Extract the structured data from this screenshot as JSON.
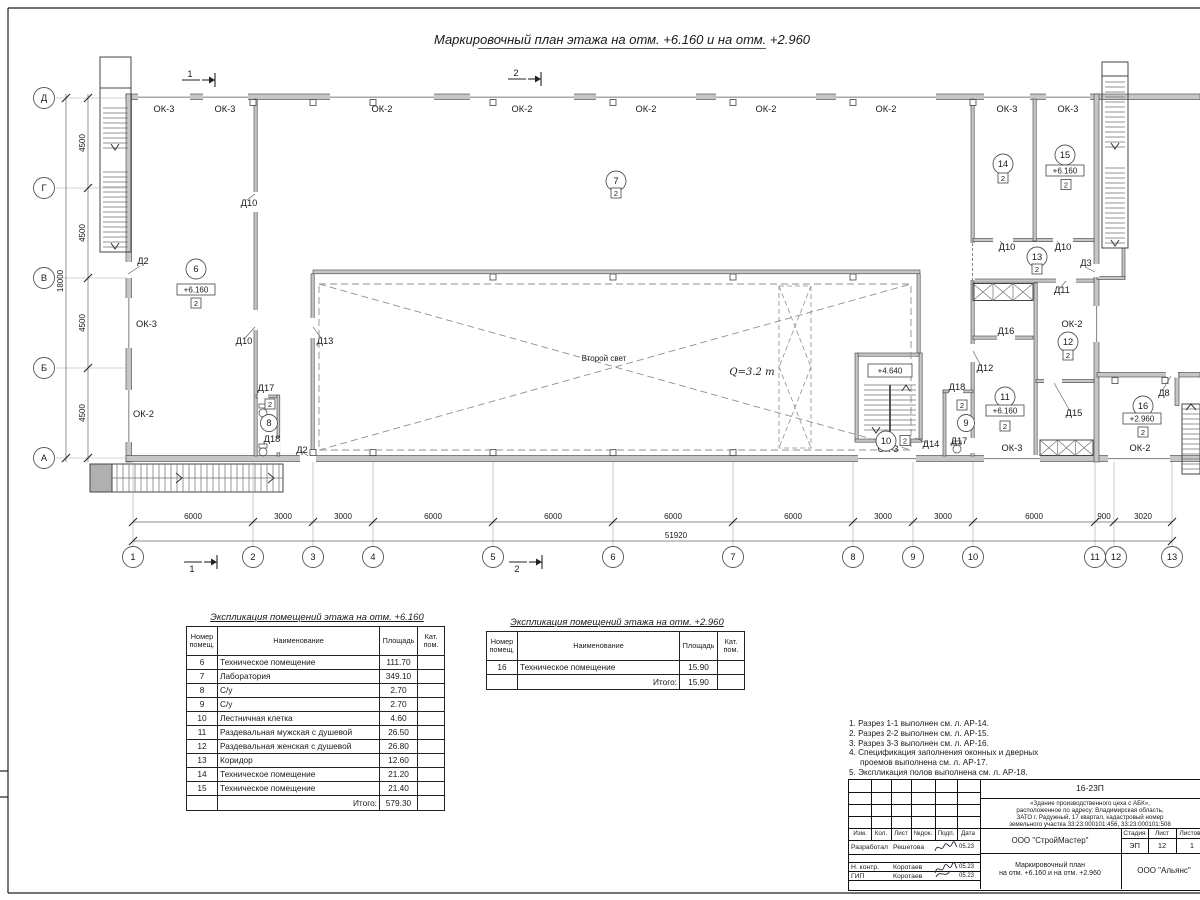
{
  "sheet_title": "Маркировочный план этажа на отм. +6.160 и на отм. +2.960",
  "plan": {
    "windows": {
      "top": [
        "ОК-3",
        "ОК-3",
        "ОК-2",
        "ОК-2",
        "ОК-2",
        "ОК-2",
        "ОК-2",
        "ОК-3",
        "ОК-3"
      ],
      "left": [
        "ОК-3",
        "ОК-2"
      ],
      "right": [
        "ОК-2"
      ],
      "bottom": [
        "ОК-3",
        "ОК-3",
        "ОК-2"
      ]
    },
    "doors": [
      "Д2",
      "Д10",
      "Д10",
      "Д13",
      "Д17",
      "Д18",
      "Д2",
      "Д14",
      "Д18",
      "Д17",
      "Д12",
      "Д16",
      "Д11",
      "Д3",
      "Д10",
      "Д10",
      "Д15",
      "Д8"
    ],
    "rooms": [
      {
        "num": "6",
        "elev": "+6.160",
        "cat": "2"
      },
      {
        "num": "7",
        "cat": "2"
      },
      {
        "num": "8",
        "cat": "2"
      },
      {
        "num": "9",
        "cat": "2"
      },
      {
        "num": "10",
        "cat": "2"
      },
      {
        "num": "11",
        "elev": "+6.160",
        "cat": "2"
      },
      {
        "num": "12",
        "cat": "2"
      },
      {
        "num": "13",
        "cat": "2"
      },
      {
        "num": "14",
        "cat": "2"
      },
      {
        "num": "15",
        "elev": "+6.160",
        "cat": "2"
      },
      {
        "num": "16",
        "elev": "+2.960",
        "cat": "2"
      }
    ],
    "stair_elev": "+4.640",
    "second_light": "Второй свет",
    "crane": "Q=3.2 т",
    "sections": {
      "s1": "1",
      "s2": "2"
    },
    "axes_v": [
      "1",
      "2",
      "3",
      "4",
      "5",
      "6",
      "7",
      "8",
      "9",
      "10",
      "11",
      "12",
      "13"
    ],
    "axes_h": [
      "Д",
      "Г",
      "В",
      "Б",
      "А"
    ],
    "dims_bottom": [
      "6000",
      "3000",
      "3000",
      "6000",
      "6000",
      "6000",
      "6000",
      "3000",
      "3000",
      "6000",
      "900",
      "3020"
    ],
    "dim_bottom_total": "51920",
    "dims_left": [
      "4500",
      "4500",
      "4500",
      "4500"
    ],
    "dim_left_total": "18000"
  },
  "tables": {
    "t1": {
      "title": "Экспликация помещений этажа на отм. +6.160",
      "headers": {
        "num": "Номер помещ.",
        "name": "Наименование",
        "area": "Площадь",
        "cat": "Кат. пом."
      },
      "rows": [
        [
          "6",
          "Техническое помещение",
          "111.70"
        ],
        [
          "7",
          "Лаборатория",
          "349.10"
        ],
        [
          "8",
          "С/у",
          "2.70"
        ],
        [
          "9",
          "С/у",
          "2.70"
        ],
        [
          "10",
          "Лестничная клетка",
          "4.60"
        ],
        [
          "11",
          "Раздевальная мужская с душевой",
          "26.50"
        ],
        [
          "12",
          "Раздевальная женская с душевой",
          "26.80"
        ],
        [
          "13",
          "Коридор",
          "12.60"
        ],
        [
          "14",
          "Техническое помещение",
          "21.20"
        ],
        [
          "15",
          "Техническое помещение",
          "21.40"
        ]
      ],
      "total_label": "Итого:",
      "total": "579.30"
    },
    "t2": {
      "title": "Экспликация помещений этажа на отм. +2.960",
      "headers": {
        "num": "Номер помещ.",
        "name": "Наименование",
        "area": "Площадь",
        "cat": "Кат. пом."
      },
      "rows": [
        [
          "16",
          "Техническое помещение",
          "15.90"
        ]
      ],
      "total_label": "Итого:",
      "total": "15.90"
    }
  },
  "notes": [
    "1. Разрез 1-1 выполнен см. л. АР-14.",
    "2. Разрез 2-2 выполнен см. л. АР-15.",
    "3. Разрез 3-3 выполнен см. л. АР-16.",
    "4. Спецификация заполнения оконных и дверных",
    "проемов выполнена см. л. АР-17.",
    "5. Экспликация полов выполнена см. л. АР-18."
  ],
  "titleblock": {
    "doc_no": "16-23П",
    "desc": [
      "«Здание производственного цеха с АБК»,",
      "расположенное по адресу: Владимирская область,",
      "ЗАТО г. Радужный, 17 квартал, кадастровый номер",
      "земельного участка 33:23:000101:456, 33:23:000101:508"
    ],
    "cols": [
      "Изм.",
      "Кол.",
      "Лист",
      "№док.",
      "Подп.",
      "Дата"
    ],
    "rows": [
      {
        "role": "Разработал",
        "name": "Решетова",
        "date": "05.23"
      },
      {
        "role": "Н. контр.",
        "name": "Коротаев",
        "date": "05.23"
      },
      {
        "role": "ГИП",
        "name": "Коротаев",
        "date": "05.23"
      }
    ],
    "stage_h": "Стадия",
    "list_h": "Лист",
    "lists_h": "Листов",
    "stage": "ЭП",
    "list": "12",
    "lists": "1",
    "org1": "ООО \"СтройМастер\"",
    "name1": "Маркировочный план",
    "name2": "на отм. +6.160 и на отм. +2.960",
    "org2": "ООО \"Альянс\""
  }
}
